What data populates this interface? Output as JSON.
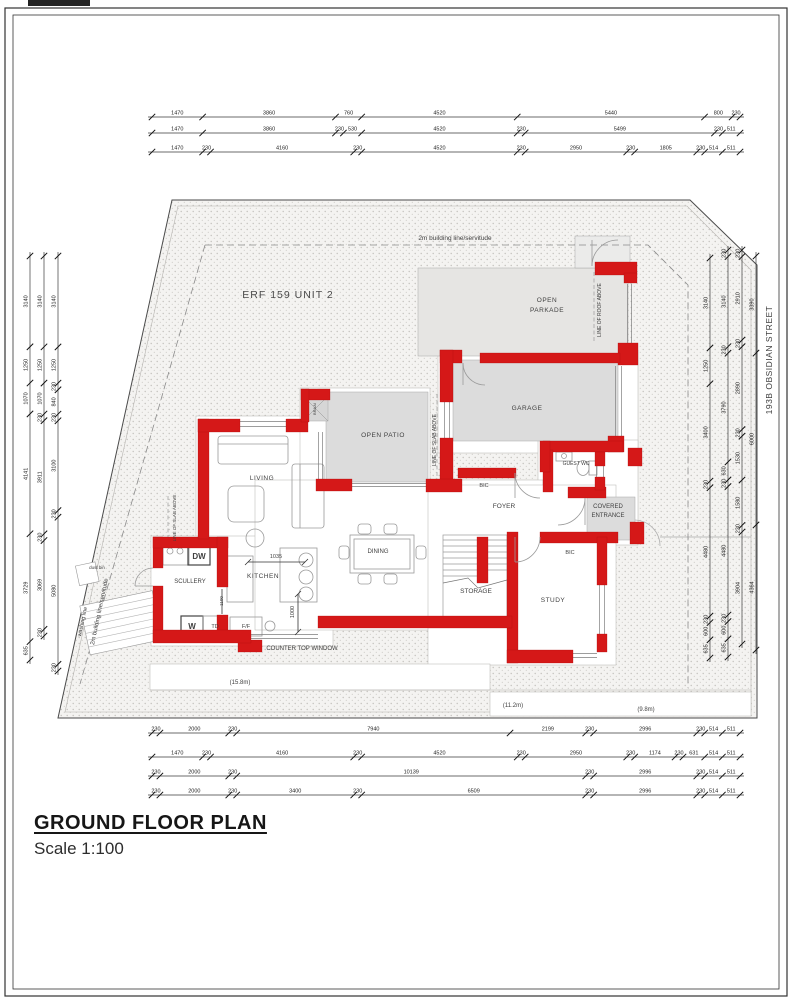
{
  "page": {
    "title": "GROUND FLOOR PLAN",
    "scale_label": "Scale 1:100"
  },
  "plan": {
    "erf": "ERF 159 UNIT 2",
    "street": "193B OBSIDIAN STREET",
    "wall_color": "#d51818",
    "slab_fill": "#dcdcdc",
    "labels": [
      {
        "id": "erf-label",
        "t": "ERF 159 UNIT 2",
        "x": 288,
        "y": 298,
        "s": 10.5,
        "sp": 1,
        "c": "#4a4a4a"
      },
      {
        "id": "building-line-top-label",
        "t": "2m building line/servitude",
        "x": 455,
        "y": 240,
        "s": 6.5
      },
      {
        "id": "building-line-left-label",
        "t": "2m building line/servitude",
        "x": 101,
        "y": 612,
        "s": 6,
        "r": -78
      },
      {
        "id": "washing-line-label",
        "t": "washing line",
        "x": 84,
        "y": 622,
        "s": 5.5,
        "r": -78
      },
      {
        "id": "dust-bin-label",
        "t": "dust bin",
        "x": 97,
        "y": 569,
        "s": 4.5
      },
      {
        "id": "street-label",
        "t": "193B OBSIDIAN STREET",
        "x": 772,
        "y": 360,
        "s": 8.5,
        "r": -90,
        "sp": 0.5
      },
      {
        "id": "room-open-parkade-1",
        "t": "OPEN",
        "x": 547,
        "y": 302,
        "s": 6.5,
        "sp": 0.5
      },
      {
        "id": "room-open-parkade-2",
        "t": "PARKADE",
        "x": 547,
        "y": 312,
        "s": 6.5,
        "sp": 0.5
      },
      {
        "id": "line-of-roof-above-label",
        "t": "LINE OF ROOF ABOVE",
        "x": 601,
        "y": 310,
        "s": 5,
        "r": -90
      },
      {
        "id": "room-garage",
        "t": "GARAGE",
        "x": 527,
        "y": 410,
        "s": 6.5,
        "sp": 0.5
      },
      {
        "id": "room-open-patio",
        "t": "OPEN PATIO",
        "x": 383,
        "y": 437,
        "s": 6.5,
        "sp": 0.5
      },
      {
        "id": "line-of-slab-above-patio-label",
        "t": "LINE OF SLAB ABOVE",
        "x": 436,
        "y": 440,
        "s": 5,
        "r": -90
      },
      {
        "id": "line-of-slab-above-left-label",
        "t": "LINE OF SLAB ABOVE",
        "x": 176,
        "y": 518,
        "s": 4.5,
        "r": -90
      },
      {
        "id": "room-living",
        "t": "LIVING",
        "x": 262,
        "y": 480,
        "s": 6.5,
        "sp": 0.5
      },
      {
        "id": "braai-label",
        "t": "BRAAI",
        "x": 316,
        "y": 409,
        "s": 4,
        "r": -90
      },
      {
        "id": "room-guest-wc",
        "t": "GUEST WC",
        "x": 576,
        "y": 465,
        "s": 5
      },
      {
        "id": "room-covered-entrance-1",
        "t": "COVERED",
        "x": 608,
        "y": 508,
        "s": 6
      },
      {
        "id": "room-covered-entrance-2",
        "t": "ENTRANCE",
        "x": 608,
        "y": 517,
        "s": 6
      },
      {
        "id": "bic-garage-label",
        "t": "BIC",
        "x": 484,
        "y": 487,
        "s": 5.5
      },
      {
        "id": "room-foyer",
        "t": "FOYER",
        "x": 504,
        "y": 508,
        "s": 6.5
      },
      {
        "id": "room-dining",
        "t": "DINING",
        "x": 378,
        "y": 553,
        "s": 6
      },
      {
        "id": "room-kitchen",
        "t": "KITCHEN",
        "x": 263,
        "y": 578,
        "s": 6.5,
        "sp": 0.5
      },
      {
        "id": "room-scullery",
        "t": "SCULLERY",
        "x": 190,
        "y": 583,
        "s": 6
      },
      {
        "id": "room-storage",
        "t": "STORAGE",
        "x": 476,
        "y": 593,
        "s": 6.5
      },
      {
        "id": "room-study",
        "t": "STUDY",
        "x": 553,
        "y": 602,
        "s": 6.5,
        "sp": 0.5
      },
      {
        "id": "bic-study-label",
        "t": "BIC",
        "x": 570,
        "y": 554,
        "s": 5.5
      },
      {
        "id": "counter-top-window-label",
        "t": "COUNTER TOP WINDOW",
        "x": 302,
        "y": 650,
        "s": 6
      },
      {
        "id": "dim-1035",
        "t": "1035",
        "x": 276,
        "y": 558,
        "s": 5.5
      },
      {
        "id": "dim-1000",
        "t": "1000",
        "x": 294,
        "y": 612,
        "s": 5.5,
        "r": -90
      },
      {
        "id": "dim-1100",
        "t": "1100",
        "x": 223,
        "y": 601,
        "s": 4.5,
        "r": -90
      },
      {
        "id": "appliance-dw",
        "t": "DW",
        "x": 199,
        "y": 559,
        "s": 8,
        "w": "bold"
      },
      {
        "id": "appliance-w",
        "t": "W",
        "x": 192,
        "y": 629,
        "s": 8,
        "w": "bold"
      },
      {
        "id": "appliance-td",
        "t": "TD",
        "x": 215,
        "y": 628,
        "s": 5.5
      },
      {
        "id": "appliance-ff",
        "t": "F/F",
        "x": 246,
        "y": 628,
        "s": 5.5
      },
      {
        "id": "width-15-8m",
        "t": "(15.8m)",
        "x": 240,
        "y": 684,
        "s": 6
      },
      {
        "id": "width-11-2m",
        "t": "(11.2m)",
        "x": 513,
        "y": 707,
        "s": 6
      },
      {
        "id": "width-9-8m",
        "t": "(9.8m)",
        "x": 646,
        "y": 711,
        "s": 6
      }
    ],
    "dim_chains": [
      {
        "id": "top-1",
        "dir": "h",
        "x": 152,
        "y": 117,
        "len": 588,
        "segs": [
          1470,
          3860,
          760,
          4520,
          5440,
          800,
          230
        ]
      },
      {
        "id": "top-2",
        "dir": "h",
        "x": 152,
        "y": 133,
        "len": 588,
        "segs": [
          1470,
          3860,
          230,
          530,
          4520,
          230,
          5499,
          230,
          511
        ]
      },
      {
        "id": "top-3",
        "dir": "h",
        "x": 152,
        "y": 152,
        "len": 588,
        "segs": [
          1470,
          230,
          4160,
          230,
          4520,
          230,
          2950,
          230,
          1805,
          230,
          514,
          511
        ]
      },
      {
        "id": "bottom-1",
        "dir": "h",
        "x": 152,
        "y": 733,
        "len": 588,
        "segs": [
          230,
          2000,
          230,
          7940,
          2199,
          230,
          2996,
          230,
          514,
          511
        ]
      },
      {
        "id": "bottom-2",
        "dir": "h",
        "x": 152,
        "y": 757,
        "len": 588,
        "segs": [
          1470,
          230,
          4160,
          230,
          4520,
          230,
          2950,
          230,
          1174,
          230,
          631,
          514,
          511
        ]
      },
      {
        "id": "bottom-3",
        "dir": "h",
        "x": 152,
        "y": 776,
        "len": 588,
        "segs": [
          230,
          2000,
          230,
          10139,
          230,
          2996,
          230,
          514,
          511
        ]
      },
      {
        "id": "bottom-4",
        "dir": "h",
        "x": 152,
        "y": 795,
        "len": 588,
        "segs": [
          230,
          2000,
          230,
          3400,
          230,
          6509,
          230,
          2996,
          230,
          514,
          511
        ]
      },
      {
        "id": "left-1",
        "dir": "v",
        "x": 30,
        "y": 256,
        "len": 404,
        "segs": [
          3140,
          1250,
          1070,
          4141,
          3729,
          635
        ]
      },
      {
        "id": "left-2",
        "dir": "v",
        "x": 44,
        "y": 256,
        "len": 380,
        "segs": [
          3140,
          1250,
          1070,
          230,
          3911,
          230,
          3069,
          230
        ]
      },
      {
        "id": "left-3",
        "dir": "v",
        "x": 58,
        "y": 256,
        "len": 415,
        "segs": [
          3140,
          1250,
          230,
          840,
          230,
          3100,
          230,
          5080,
          230
        ]
      },
      {
        "id": "right-1",
        "dir": "v",
        "x": 710,
        "y": 258,
        "len": 400,
        "segs": [
          3140,
          1250,
          3400,
          230,
          4480,
          230,
          600,
          635
        ]
      },
      {
        "id": "right-2",
        "dir": "v",
        "x": 728,
        "y": 250,
        "len": 407,
        "segs": [
          230,
          3140,
          230,
          3790,
          630,
          230,
          4480,
          230,
          600,
          635
        ]
      },
      {
        "id": "right-3",
        "dir": "v",
        "x": 742,
        "y": 250,
        "len": 394,
        "segs": [
          230,
          2910,
          230,
          2890,
          230,
          1530,
          1580,
          230,
          3904
        ]
      },
      {
        "id": "right-4",
        "dir": "v",
        "x": 756,
        "y": 256,
        "len": 394,
        "segs": [
          3390,
          6000,
          4364
        ]
      }
    ]
  }
}
